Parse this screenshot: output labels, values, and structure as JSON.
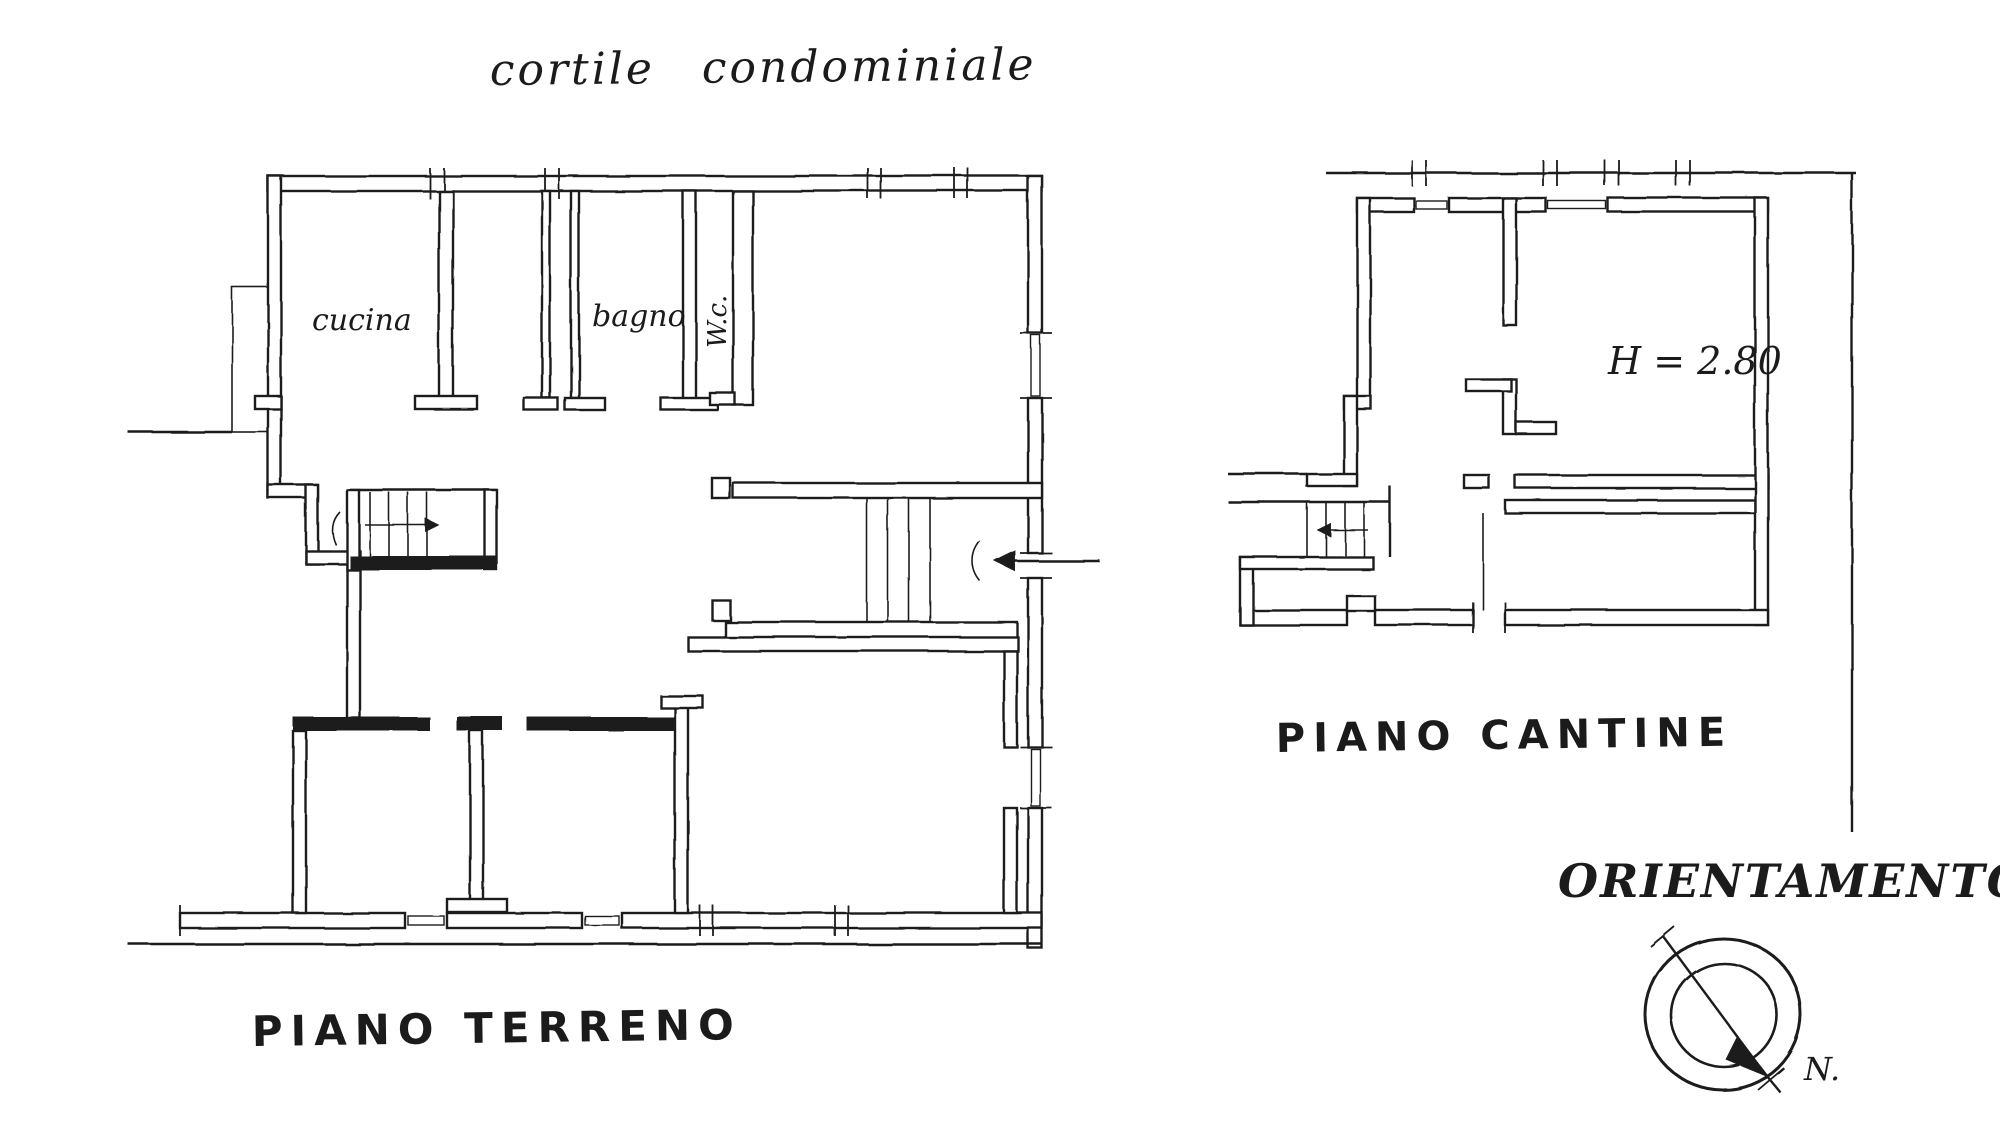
{
  "page": {
    "background": "#ffffff",
    "ink": "#1b1b1b"
  },
  "annotations": {
    "courtyard_label": "cortile condominiale",
    "ground_floor": {
      "title": "PIANO TERRENO",
      "kitchen": "cucina",
      "bathroom": "bagno",
      "wc": "W.c."
    },
    "basement": {
      "title": "PIANO CANTINE",
      "ceiling_height": "H = 2.80"
    },
    "orientation": {
      "title": "ORIENTAMENTO",
      "north_mark": "N."
    }
  }
}
